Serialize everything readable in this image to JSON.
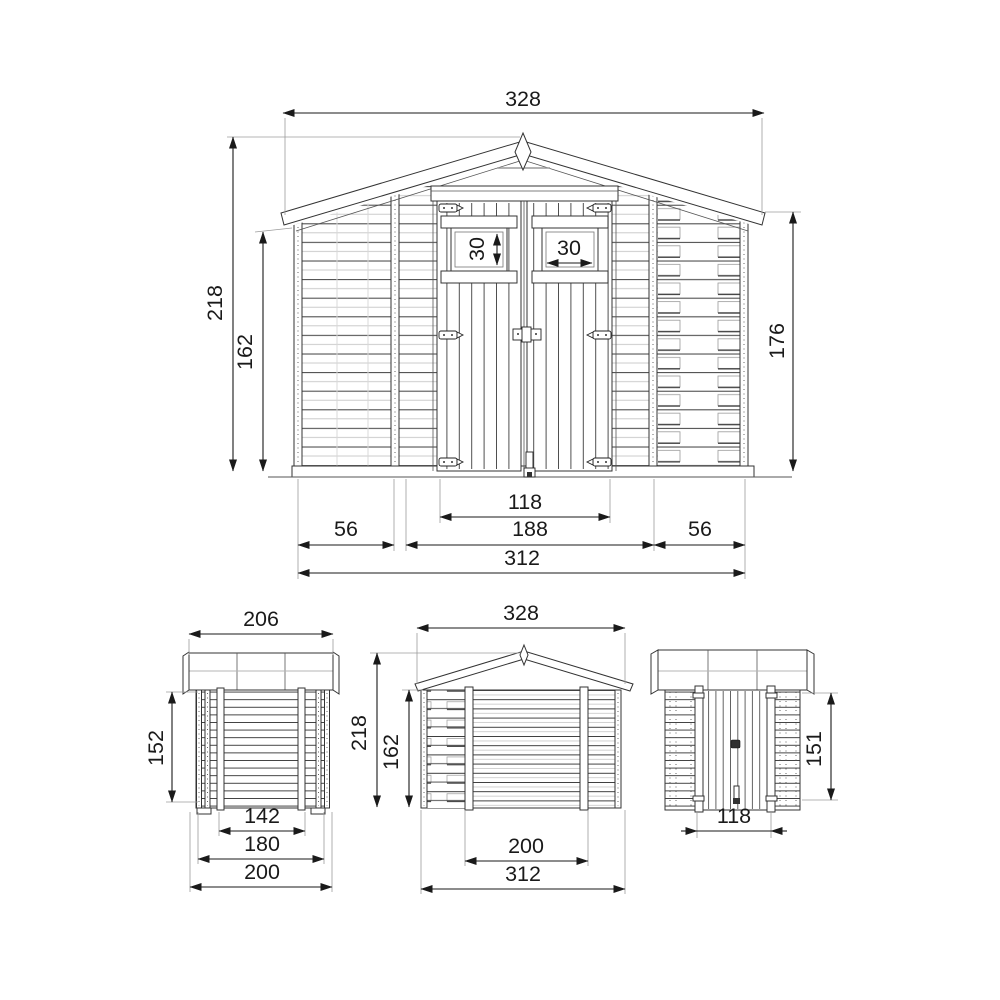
{
  "front": {
    "roof_width": "328",
    "total_height": "218",
    "wall_height": "162",
    "eaves_height": "176",
    "window_height": "30",
    "window_width": "30",
    "door_width": "118",
    "center_width": "188",
    "left_width": "56",
    "right_width": "56",
    "base_width": "312"
  },
  "side": {
    "roof_width": "206",
    "wall_height": "152",
    "inner_width": "142",
    "wall_width": "180",
    "base_width": "200"
  },
  "rear": {
    "roof_width": "328",
    "total_height": "218",
    "wall_height": "162",
    "inner_width": "200",
    "base_width": "312"
  },
  "door": {
    "door_height": "151",
    "door_width": "118"
  },
  "colors": {
    "line": "#333333",
    "dim": "#1a1a1a",
    "light_line": "#c4c4c4",
    "background": "#ffffff"
  }
}
